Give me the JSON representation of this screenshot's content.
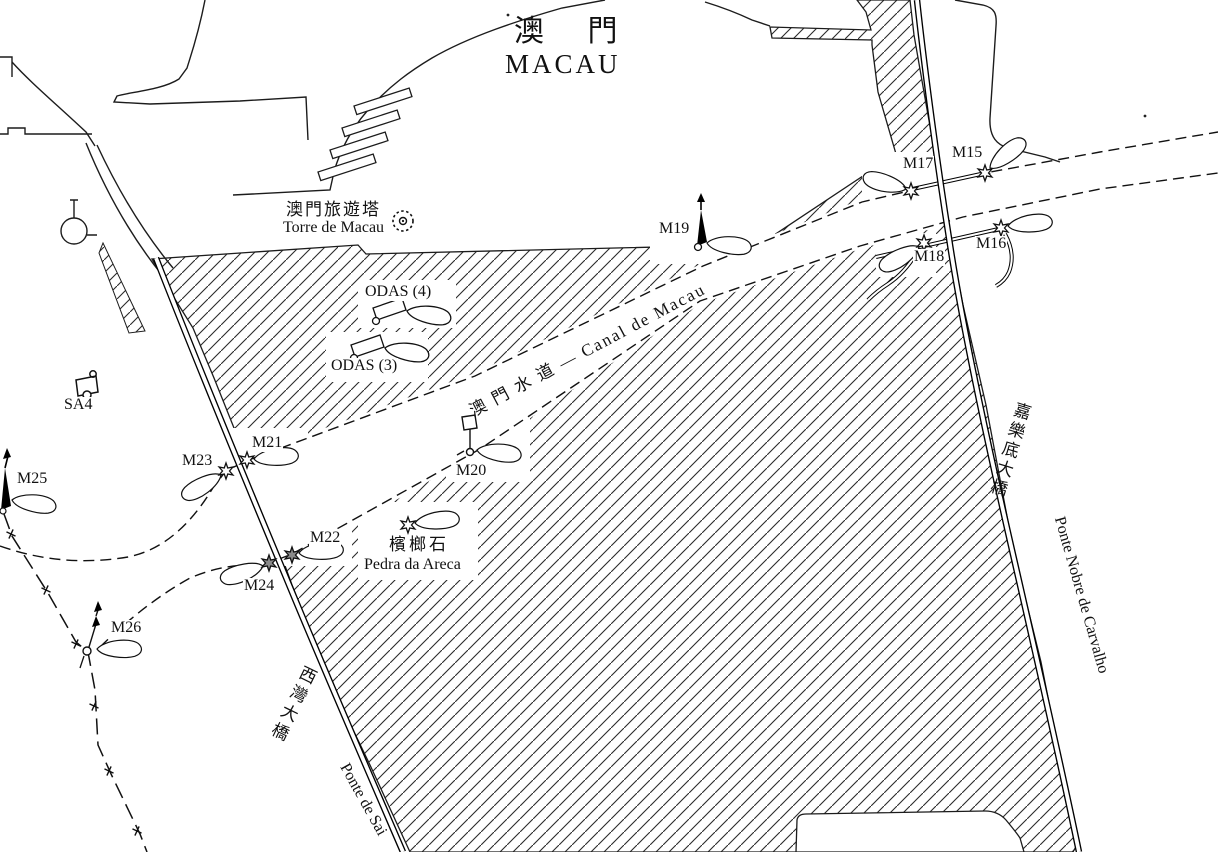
{
  "title": {
    "zh": "澳 門",
    "en": "MACAU"
  },
  "landmarks": {
    "tower_zh": "澳門旅遊塔",
    "tower_en": "Torre de Macau",
    "rock_zh": "檳榔石",
    "rock_en": "Pedra da Areca",
    "anchorage": "SA4"
  },
  "channel": {
    "name": "澳 門 水 道 — Canal de Macau"
  },
  "bridges": {
    "saivan_zh": "西灣大橋",
    "saivan_en": "Ponte de Sai",
    "carvalho_zh": "嘉樂底大橋",
    "carvalho_en": "Ponte Nobre de Carvalho"
  },
  "odas": {
    "o4": "ODAS (4)",
    "o3": "ODAS (3)"
  },
  "marks": {
    "m15": "M15",
    "m16": "M16",
    "m17": "M17",
    "m18": "M18",
    "m19": "M19",
    "m20": "M20",
    "m21": "M21",
    "m22": "M22",
    "m23": "M23",
    "m24": "M24",
    "m25": "M25",
    "m26": "M26"
  }
}
